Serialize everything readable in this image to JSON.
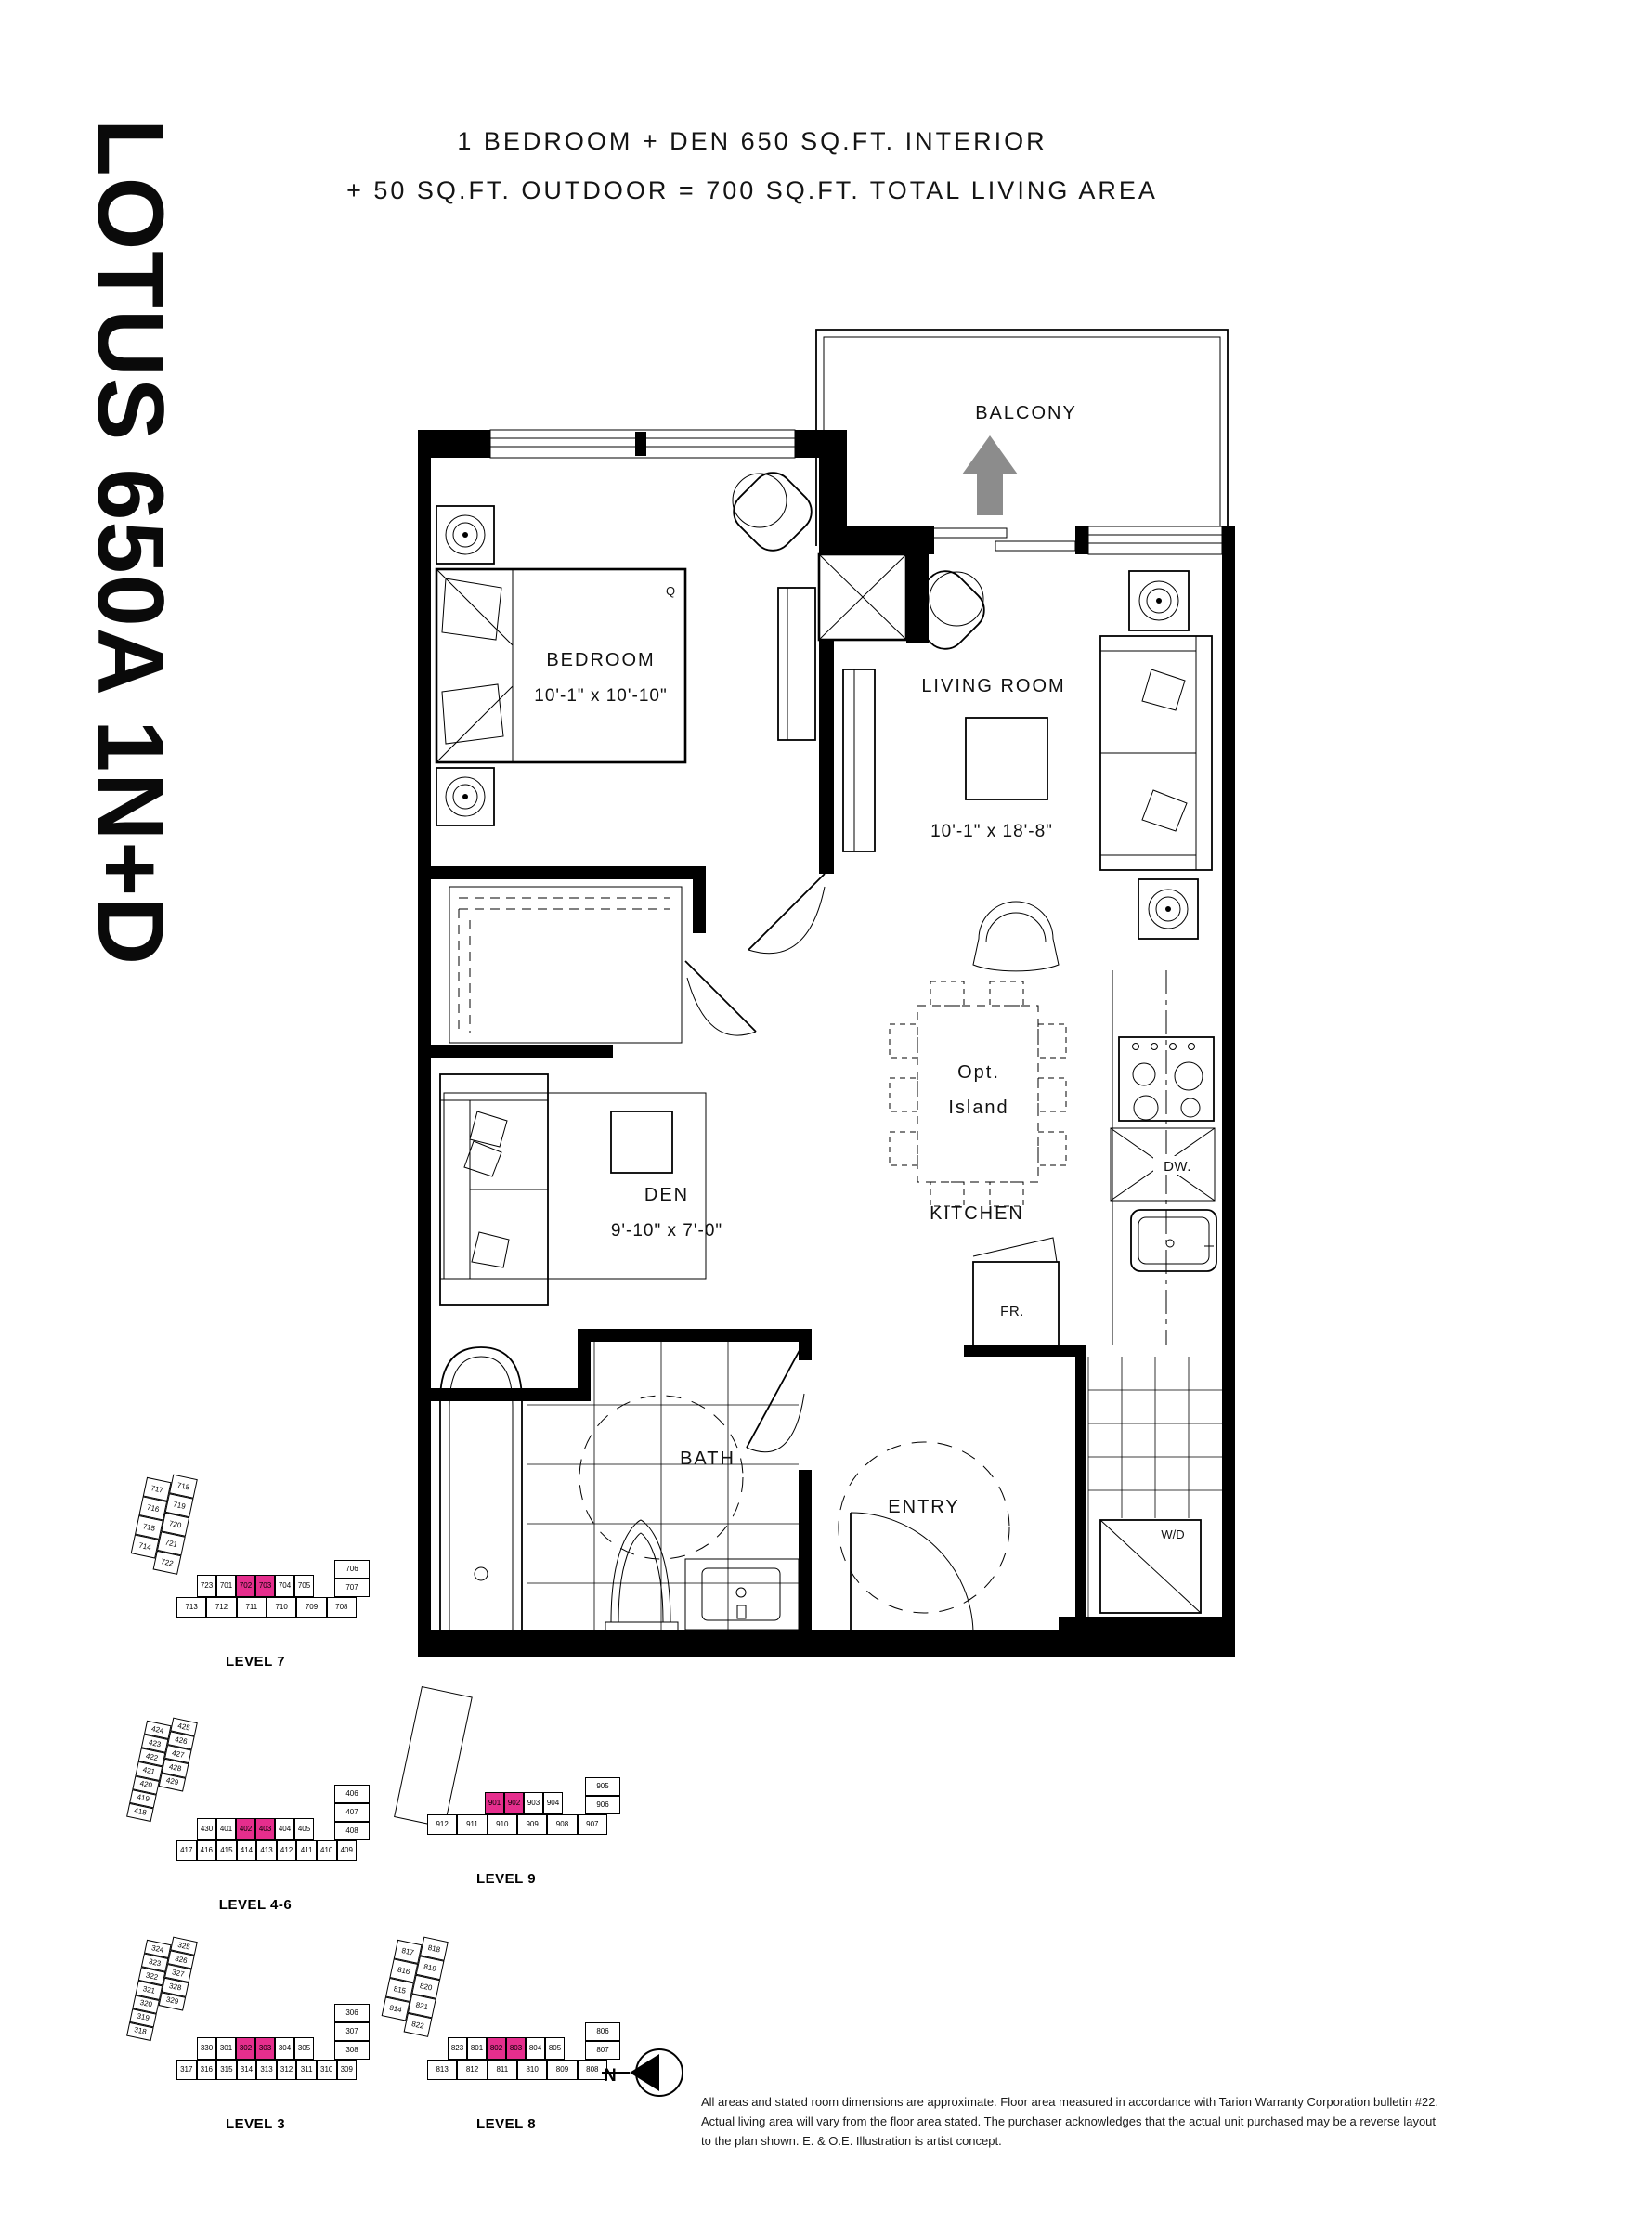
{
  "page": {
    "title_vertical": "LOTUS 650A 1N+D",
    "header_line1": "1 BEDROOM + DEN 650 SQ.FT. INTERIOR",
    "header_line2": "+ 50 SQ.FT. OUTDOOR = 700 SQ.FT. TOTAL LIVING AREA",
    "north_label": "N",
    "disclaimer": "All areas and stated room dimensions are approximate. Floor area measured in accordance with Tarion Warranty Corporation bulletin #22. Actual living area will vary from the floor area stated. The purchaser acknowledges that the actual unit purchased may be a reverse layout to the plan shown. E. & O.E. Illustration is artist concept."
  },
  "colors": {
    "highlight": "#E52E8D",
    "arrow_gray": "#8C8C8C"
  },
  "floorplan": {
    "rooms": {
      "balcony": {
        "label": "BALCONY"
      },
      "bedroom": {
        "label": "BEDROOM",
        "dims": "10'-1\" x 10'-10\""
      },
      "living_room": {
        "label": "LIVING ROOM",
        "dims": "10'-1\" x 18'-8\""
      },
      "den": {
        "label": "DEN",
        "dims": "9'-10\" x 7'-0\""
      },
      "kitchen": {
        "label": "KITCHEN"
      },
      "bath": {
        "label": "BATH"
      },
      "entry": {
        "label": "ENTRY"
      }
    },
    "fixtures": {
      "island_line1": "Opt.",
      "island_line2": "Island",
      "dishwasher": "DW.",
      "fridge": "FR.",
      "washer_dryer": "W/D",
      "bed_size": "Q"
    }
  },
  "keyplans": [
    {
      "label": "LEVEL 7",
      "highlight": [
        "702",
        "703"
      ],
      "diag_left": [
        "717",
        "716",
        "715",
        "714"
      ],
      "diag_right": [
        "718",
        "719",
        "720",
        "721",
        "722"
      ],
      "row_top": [
        "723",
        "701",
        "702",
        "703",
        "704",
        "705"
      ],
      "col_right": [
        "706",
        "707"
      ],
      "row_bottom": [
        "713",
        "712",
        "711",
        "710",
        "709",
        "708"
      ]
    },
    {
      "label": "LEVEL 4-6",
      "highlight": [
        "402",
        "403"
      ],
      "diag_left": [
        "424",
        "423",
        "422",
        "421",
        "420",
        "419",
        "418"
      ],
      "diag_right": [
        "425",
        "426",
        "427",
        "428",
        "429"
      ],
      "row_top": [
        "430",
        "401",
        "402",
        "403",
        "404",
        "405"
      ],
      "col_right": [
        "406",
        "407",
        "408"
      ],
      "row_bottom": [
        "417",
        "416",
        "415",
        "414",
        "413",
        "412",
        "411",
        "410",
        "409"
      ]
    },
    {
      "label": "LEVEL 9",
      "highlight": [
        "901",
        "902"
      ],
      "diag_left": [],
      "diag_right": [],
      "row_top": [
        "901",
        "902",
        "903",
        "904"
      ],
      "col_right": [
        "905",
        "906"
      ],
      "row_bottom": [
        "912",
        "911",
        "910",
        "909",
        "908",
        "907"
      ]
    },
    {
      "label": "LEVEL 3",
      "highlight": [
        "302",
        "303"
      ],
      "diag_left": [
        "324",
        "323",
        "322",
        "321",
        "320",
        "319",
        "318"
      ],
      "diag_right": [
        "325",
        "326",
        "327",
        "328",
        "329"
      ],
      "row_top": [
        "330",
        "301",
        "302",
        "303",
        "304",
        "305"
      ],
      "col_right": [
        "306",
        "307",
        "308"
      ],
      "row_bottom": [
        "317",
        "316",
        "315",
        "314",
        "313",
        "312",
        "311",
        "310",
        "309"
      ]
    },
    {
      "label": "LEVEL 8",
      "highlight": [
        "802",
        "803"
      ],
      "diag_left": [
        "817",
        "816",
        "815",
        "814"
      ],
      "diag_right": [
        "818",
        "819",
        "820",
        "821",
        "822"
      ],
      "row_top": [
        "823",
        "801",
        "802",
        "803",
        "804",
        "805"
      ],
      "col_right": [
        "806",
        "807"
      ],
      "row_bottom": [
        "813",
        "812",
        "811",
        "810",
        "809",
        "808"
      ]
    }
  ]
}
